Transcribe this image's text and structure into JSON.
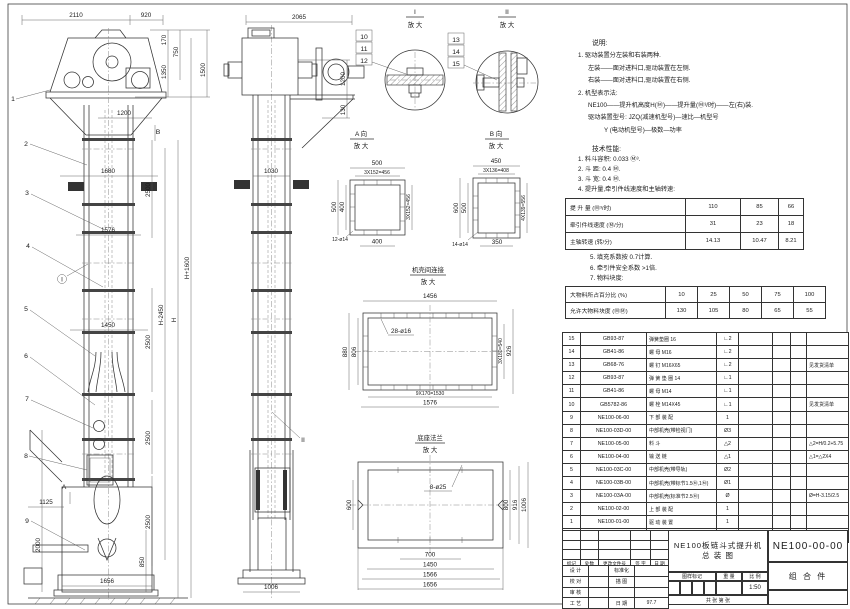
{
  "notes": {
    "heading": "说明:",
    "lines": [
      "1. 驱动装置分左装和右装两种.",
      "左装——面对进料口,驱动装置在左侧.",
      "右装——面对进料口,驱动装置在右侧.",
      "2. 机型表示法:",
      "NE100——提升机高度H(Ⓜ)——提升量(Ⓜ³/时)——左(右)装.",
      "驱动装置型号: JZQ(减速机型号)—速比—机型号",
      "Y (电动机型号)—极数—功率"
    ]
  },
  "tech": {
    "heading": "技术性能:",
    "items": [
      "1. 料斗容积: 0.033 Ⓜ³.",
      "2. 斗   距: 0.4 Ⓜ.",
      "3. 斗   宽: 0.4 Ⓜ.",
      "4. 提升量,牵引件线速度和主轴转速:"
    ],
    "perf": {
      "rows": [
        {
          "label": "提 升 量   (Ⓜ³/时)",
          "v": [
            "110",
            "85",
            "66"
          ]
        },
        {
          "label": "牵引件线速度 (Ⓜ/分)",
          "v": [
            "31",
            "23",
            "18"
          ]
        },
        {
          "label": "主轴转速 (转/分)",
          "v": [
            "14.13",
            "10.47",
            "8.21"
          ]
        }
      ]
    },
    "items2": [
      "5. 填充系数按 0.7计算.",
      "6. 牵引件安全系数 >1倍.",
      "7. 物料块度:"
    ],
    "lump": {
      "rows": [
        {
          "label": "大物料所占百分比 (%)",
          "v": [
            "10",
            "25",
            "50",
            "75",
            "100"
          ]
        },
        {
          "label": "允许大物料块度 (ⓂⓂ)",
          "v": [
            "130",
            "105",
            "80",
            "65",
            "55"
          ]
        }
      ]
    }
  },
  "bom": {
    "headers": [
      "序号",
      "代  号",
      "名  称",
      "数量",
      "材  料",
      "单重",
      "总重",
      "备 注"
    ],
    "rows": [
      {
        "no": "15",
        "code": "GB93-87",
        "name": "弹簧垫圈  16",
        "qty": "∟2",
        "remark": ""
      },
      {
        "no": "14",
        "code": "GB41-86",
        "name": "螺 母  M16",
        "qty": "∟2",
        "remark": ""
      },
      {
        "no": "13",
        "code": "GB68-76",
        "name": "螺 钉  M16X65",
        "qty": "∟2",
        "remark": "见发货清单"
      },
      {
        "no": "12",
        "code": "GB93-87",
        "name": "弹 簧 垫 圈  14",
        "qty": "∟1",
        "remark": ""
      },
      {
        "no": "11",
        "code": "GB41-86",
        "name": "螺 母  M14",
        "qty": "∟1",
        "remark": ""
      },
      {
        "no": "10",
        "code": "GB5782-86",
        "name": "螺 栓  M14X45",
        "qty": "∟1",
        "remark": "见发货清单"
      },
      {
        "no": "9",
        "code": "NE100-06-00",
        "name": "下 部 装 配",
        "qty": "1",
        "remark": ""
      },
      {
        "no": "8",
        "code": "NE100-03D-00",
        "name": "中部机壳(带检视门)",
        "qty": "Ø3",
        "remark": ""
      },
      {
        "no": "7",
        "code": "NE100-05-00",
        "name": "料  斗",
        "qty": "△2",
        "remark": "△2=H/0.2+5.75"
      },
      {
        "no": "6",
        "code": "NE100-04-00",
        "name": "输 送 链",
        "qty": "△1",
        "remark": "△1=△2X4"
      },
      {
        "no": "5",
        "code": "NE100-03C-00",
        "name": "中部机壳(带导轨)",
        "qty": "Ø2",
        "remark": ""
      },
      {
        "no": "4",
        "code": "NE100-03B-00",
        "name": "中部机壳(带标节1.5Ⓜ,1Ⓜ)",
        "qty": "Ø1",
        "remark": ""
      },
      {
        "no": "3",
        "code": "NE100-03A-00",
        "name": "中部机壳(标准节2.5Ⓜ)",
        "qty": "Ø",
        "remark": "Ø=H-3.15/2.5"
      },
      {
        "no": "2",
        "code": "NE100-02-00",
        "name": "上 部 装 配",
        "qty": "1",
        "remark": ""
      },
      {
        "no": "1",
        "code": "NE100-01-00",
        "name": "驱 动 装 置",
        "qty": "1",
        "remark": ""
      }
    ]
  },
  "title_block": {
    "product": "NE100板链斗式提升机",
    "doc_type": "总  装  图",
    "drawing_no": "NE100-00-00",
    "part_class": "组 合 件",
    "scale": "1:50",
    "date": "97.7",
    "rev_headers": [
      "标记",
      "处数",
      "更改文件号",
      "签 字",
      "日 期"
    ],
    "roles": [
      {
        "l": "设 计",
        "m": "标准化",
        "r": ""
      },
      {
        "l": "校 对",
        "m": "描 图",
        "r": ""
      },
      {
        "l": "审 核",
        "m": "",
        "r": ""
      },
      {
        "l": "工 艺",
        "m": "日 期",
        "r": "97.7"
      }
    ],
    "stamp": [
      "图样标记",
      "重 量",
      "比 例"
    ],
    "sheet": "共  张  第  张"
  },
  "views": {
    "mag": "放 大",
    "front": {
      "dims": {
        "w2110": "2110",
        "w920": "920",
        "h170": "170",
        "h750": "750",
        "h1350": "1350",
        "h1500": "1500",
        "w1200": "1200",
        "w1680": "1680",
        "h2500": "2500",
        "w1576": "1576",
        "hH2450": "H-2450",
        "hH": "H",
        "hH1600": "H+1600",
        "w1450": "1450",
        "w1125": "1125",
        "h2000": "2000",
        "h850": "850",
        "w1656": "1656"
      },
      "callouts": [
        "1",
        "2",
        "3",
        "4",
        "5",
        "6",
        "7",
        "8",
        "9"
      ],
      "markers": {
        "a": "A",
        "b": "B",
        "i": "I"
      }
    },
    "side": {
      "dims": {
        "w2065": "2065",
        "h1200": "1200",
        "h130": "130",
        "w1030": "1030",
        "w1006": "1006"
      },
      "marker": "II"
    },
    "detail1": {
      "label": "I",
      "callouts": [
        "10",
        "11",
        "12"
      ]
    },
    "detail2": {
      "label": "II",
      "callouts": [
        "13",
        "14",
        "15"
      ]
    },
    "viewA": {
      "label": "A 向",
      "d500": "500",
      "d456": "3X152=456",
      "d400": "400",
      "holes": "12-ø14"
    },
    "viewB": {
      "label": "B 向",
      "d450": "450",
      "d408": "3X136=408",
      "d600": "600",
      "d500": "500",
      "d556": "4X139=556",
      "d350": "350",
      "holes": "14-ø14"
    },
    "flange": {
      "label": "机壳间连接",
      "d1456": "1456",
      "d880": "880",
      "d806": "806",
      "d540": "3X180=540",
      "d926": "926",
      "d1530": "9X170=1530",
      "d1576": "1576",
      "holes": "28-ø16"
    },
    "base": {
      "label": "底座法兰",
      "holes": "8-ø25",
      "d600": "600",
      "d800": "800",
      "d916": "916",
      "d1006": "1006",
      "d700": "700",
      "d1450": "1450",
      "d1566": "1566",
      "d1656": "1656"
    }
  }
}
